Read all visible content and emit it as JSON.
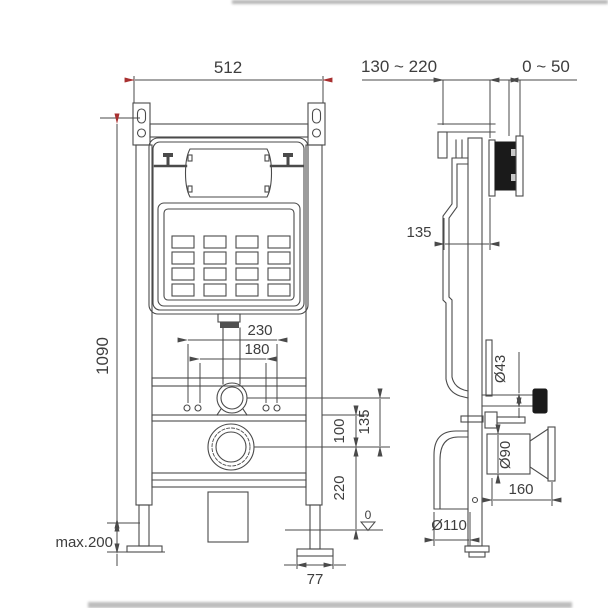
{
  "drawing": {
    "title": "concealed-cistern-installation-drawing",
    "colors": {
      "line": "#4a4a4a",
      "accent_red": "#a83030",
      "fill_black": "#1a1a1a",
      "background": "#ffffff"
    },
    "front_view": {
      "dims": {
        "frame_width": "512",
        "frame_height": "1090",
        "bolt_spacing_outer": "230",
        "bolt_spacing_inner": "180",
        "rail_to_drain": "100",
        "bend_to_drain": "135",
        "drain_height": "220",
        "leg_adjustment": "max.200",
        "foot_width": "77",
        "floor_level": "0"
      }
    },
    "side_view": {
      "dims": {
        "install_depth_range": "130 ~ 220",
        "wall_finish_range": "0 ~ 50",
        "tank_depth": "135",
        "inlet_diameter": "Ø43",
        "flush_pipe_diameter": "Ø90",
        "flush_pipe_length": "160",
        "drain_diameter": "Ø110"
      }
    }
  }
}
